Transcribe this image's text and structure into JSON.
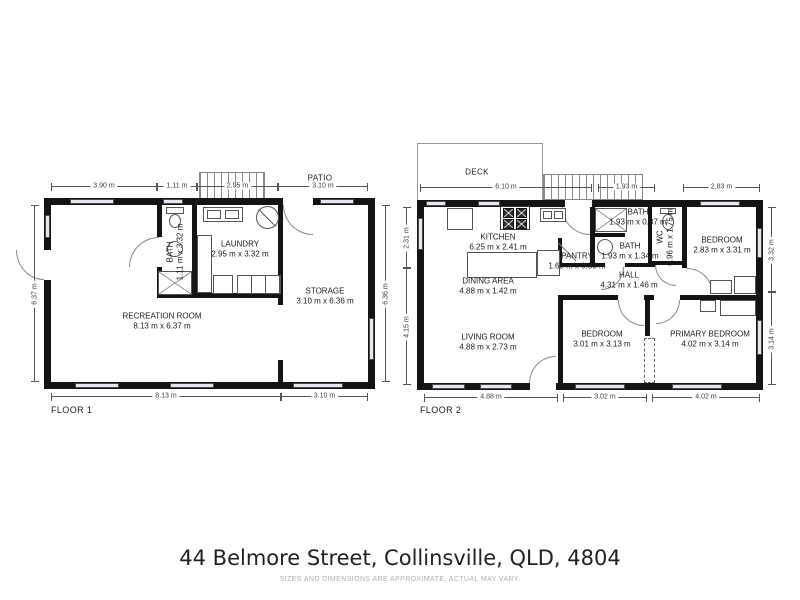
{
  "title": "44 Belmore Street, Collinsville, QLD, 4804",
  "disclaimer": "SIZES AND DIMENSIONS ARE APPROXIMATE, ACTUAL MAY VARY.",
  "colors": {
    "wall": "#141414",
    "window_fill": "#e4e7ee",
    "dim_line": "#555555",
    "text": "#1c1c1c",
    "disclaimer_text": "#b3aeab"
  },
  "floor1": {
    "label": "FLOOR 1",
    "patio_label": "PATIO",
    "rooms": {
      "recreation": {
        "name": "RECREATION ROOM",
        "dims": "8.13 m x 6.37 m"
      },
      "bath": {
        "name": "BATH",
        "dims": "1.11 m x 3.32 m"
      },
      "laundry": {
        "name": "LAUNDRY",
        "dims": "2.95 m x 3.32 m"
      },
      "storage": {
        "name": "STORAGE",
        "dims": "3.10 m x 6.36 m"
      }
    },
    "dims_top": [
      "3.90 m",
      "1.11 m",
      "2.95 m",
      "3.10 m"
    ],
    "dims_bottom": [
      "8.13 m",
      "3.10 m"
    ],
    "dims_left": [
      "6.37 m"
    ],
    "dims_right": [
      "6.36 m"
    ]
  },
  "floor2": {
    "label": "FLOOR 2",
    "deck_label": "DECK",
    "rooms": {
      "kitchen": {
        "name": "KITCHEN",
        "dims": "6.25 m x 2.41 m"
      },
      "pantry": {
        "name": "PANTRY",
        "dims": "1.63 m x 0.83 m"
      },
      "bath_top": {
        "name": "BATH",
        "dims": "1.93 m x 0.87 m"
      },
      "bath_mid": {
        "name": "BATH",
        "dims": "1.93 m x 1.34 m"
      },
      "wc": {
        "name": "WC",
        "dims": "0.96 m x 1.75 m"
      },
      "bedroom_top": {
        "name": "BEDROOM",
        "dims": "2.83 m x 3.31 m"
      },
      "dining": {
        "name": "DINING AREA",
        "dims": "4.88 m x 1.42 m"
      },
      "hall": {
        "name": "HALL",
        "dims": "4.31 m x 1.46 m"
      },
      "living": {
        "name": "LIVING ROOM",
        "dims": "4.88 m x 2.73 m"
      },
      "bedroom_mid": {
        "name": "BEDROOM",
        "dims": "3.01 m x 3.13 m"
      },
      "primary": {
        "name": "PRIMARY BEDROOM",
        "dims": "4.02 m x 3.14 m"
      }
    },
    "dims_top": [
      "6.10 m",
      "1.93 m",
      "2.83 m"
    ],
    "dims_bottom": [
      "4.88 m",
      "3.02 m",
      "4.02 m"
    ],
    "dims_left": [
      "2.31 m",
      "4.15 m"
    ],
    "dims_right": [
      "3.32 m",
      "3.14 m"
    ]
  }
}
